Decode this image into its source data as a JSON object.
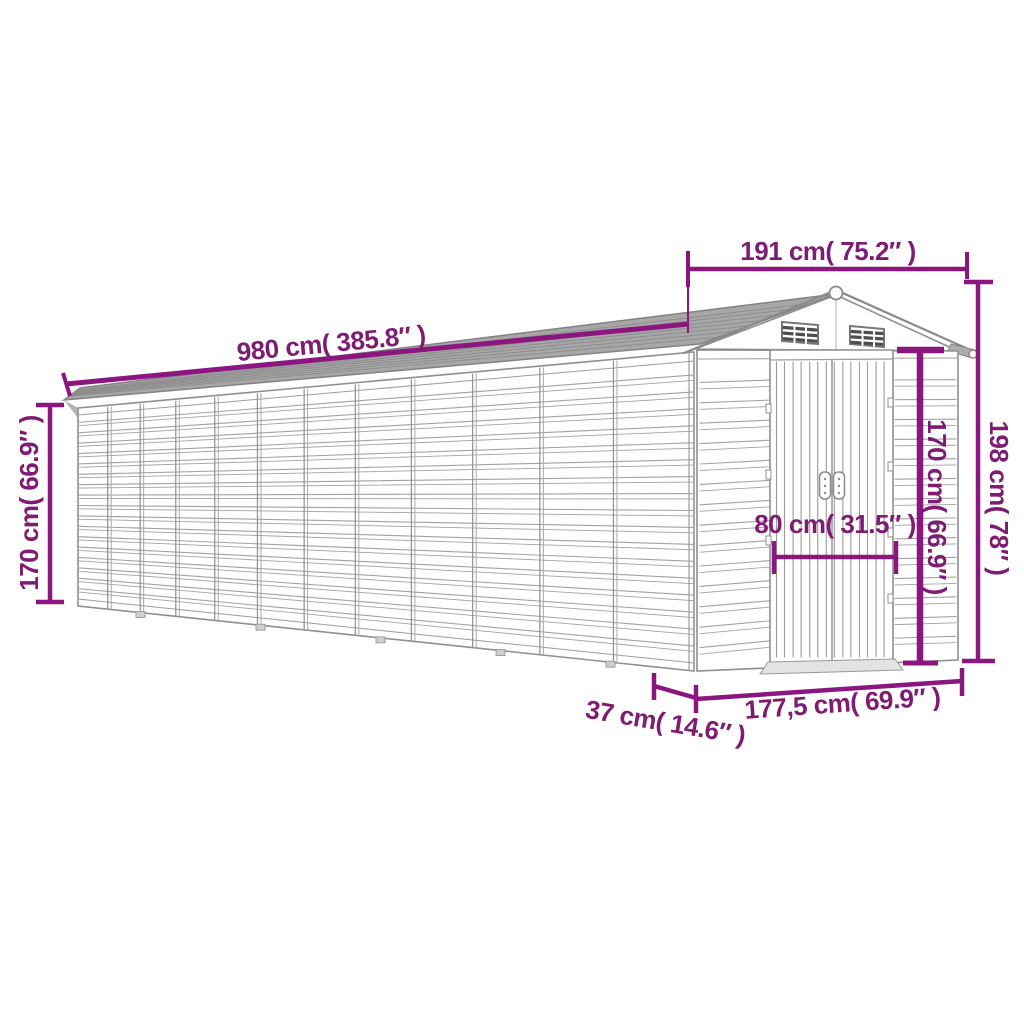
{
  "figure": {
    "type": "product dimension diagram",
    "subject": "metal garden shed with double doors and gable roof",
    "accent_color": "#8C1680",
    "text_color": "#7E1B72",
    "outline_color": "#8f8f8f",
    "roof_fill": "#a7a7a7",
    "background": "#ffffff"
  },
  "dimensions": {
    "front_width": "191 cm( 75.2″ )",
    "roof_length": "980 cm( 385.8″ )",
    "side_height": "170 cm( 66.9″ )",
    "total_height": "198 cm( 78″ )",
    "door_height": "170 cm( 66.9″ )",
    "door_width": "80 cm( 31.5″ )",
    "base_depth": "37 cm( 14.6″ )",
    "base_width": "177,5 cm( 69.9″ )"
  }
}
